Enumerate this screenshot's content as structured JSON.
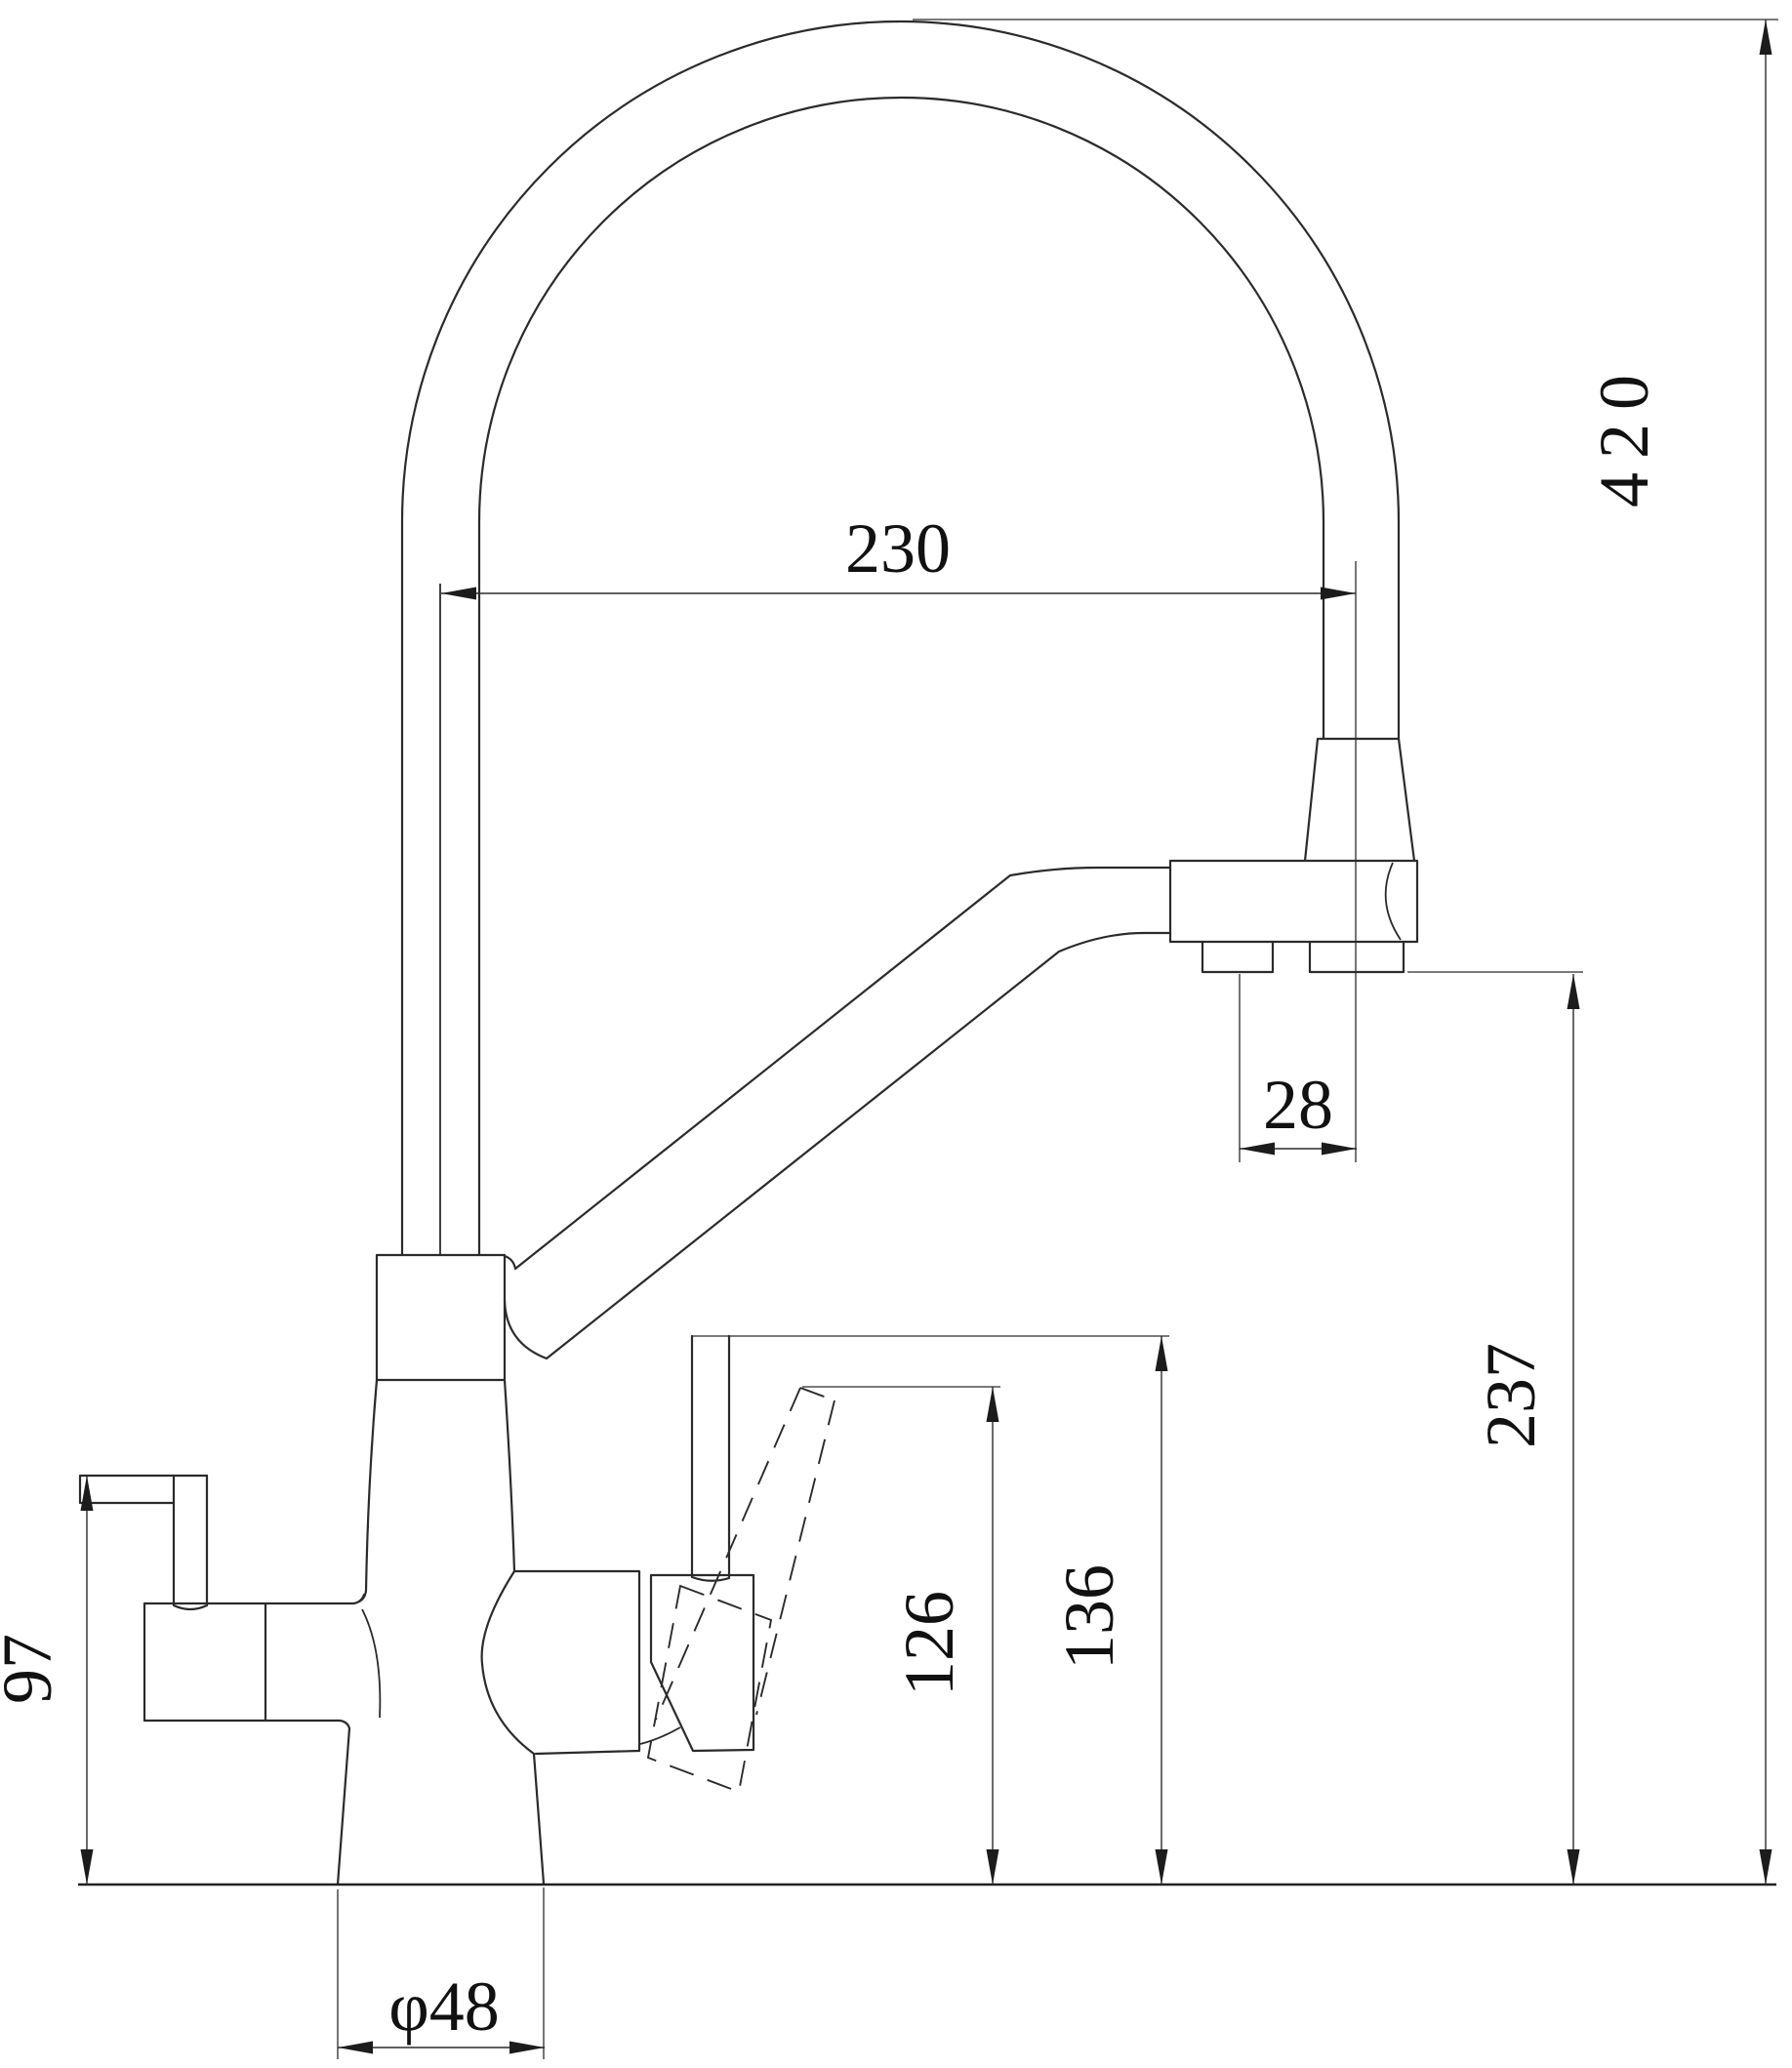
{
  "page": {
    "background": "#ffffff",
    "kind": "engineering dimension drawing",
    "subject": "kitchen faucet with filter channel, side elevation"
  },
  "drawing": {
    "line_color": "#2b2b2b",
    "labels": {
      "spout_reach": "230",
      "outlet_spacing": "28",
      "total_height": "420",
      "spout_outlet_height": "237",
      "lever_top_height": "136",
      "lever_alt_height": "126",
      "filter_handle_height": "97",
      "base_diameter": "φ48"
    }
  }
}
